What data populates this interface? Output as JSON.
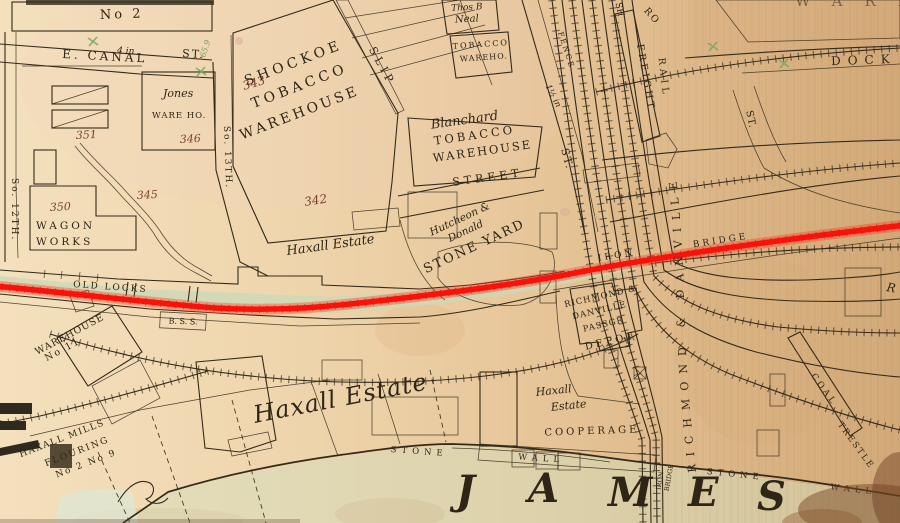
{
  "colors": {
    "annotation_red": "#fa120a",
    "paper": "#ecd0a7",
    "building_pink": "#efcfc0",
    "building_tan": "#e6c089",
    "green_lot": "#ccd8b8",
    "ink": "#332a1b",
    "parcel_number_red": "#7e4030",
    "survey_green": "#75a25f"
  },
  "labels": {
    "no2": "No 2",
    "e_canal": "E. CANAL",
    "pipe4": "4 in",
    "st_canal": "ST.",
    "s12": "So. 12TH.",
    "s13": "So. 13TH.",
    "m659": "65.9",
    "jones1": "Jones",
    "jones2": "WARE HO.",
    "n346": "346",
    "n351": "351",
    "n345": "345",
    "n350": "350",
    "wagon1": "WAGON",
    "wagon2": "WORKS",
    "n343": "343",
    "n342": "342",
    "shockoe1": "SHOCKOE",
    "shockoe2": "TOBACCO",
    "shockoe3": "WAREHOUSE",
    "slip": "SLIP",
    "neal1": "Thos B",
    "neal2": "Neal",
    "neal3": "TOBACCO",
    "neal4": "WAREHO.",
    "blanchard1": "Blanchard",
    "blanchard2": "TOBACCO",
    "blanchard3": "WAREHOUSE",
    "street": "STREET",
    "hutcheon1": "Hutcheon &",
    "hutcheon2": "Donald",
    "hutcheon3": "STONE YARD",
    "haxall_small": "Haxall Estate",
    "haxall_large": "Haxall Estate",
    "haxall3a": "Haxall",
    "haxall3b": "Estate",
    "pipe15": "1½ in",
    "st14": "ST.",
    "fence": "FENCE",
    "sh": "SH",
    "freight": "FREIGHT",
    "rail": "RAIL",
    "ro": "RO",
    "rd": "RICHMOND & DANVILLE",
    "st_cross": "ST.",
    "dock": "DOCK",
    "wareh_partial": "WAREH",
    "depot1": "RICHMOND &",
    "depot2": "DANVILLE",
    "depot3": "PASSGR",
    "depot4": "DEPOT",
    "old_locks": "OLD LOCKS",
    "bss": "B. S. S.",
    "iron_h": "IRON",
    "bridge_h": "BRIDGE",
    "iron_v": "IRON",
    "bridge_v": "BRIDGE",
    "wh11a": "WAREHOUSE",
    "wh11b": "No 11",
    "mills1": "HAXALL MILLS",
    "mills2": "FLOURING",
    "mills3": "No 2   No 9",
    "cooperage": "COOPERAGE",
    "stone1": "STONE",
    "wall1": "WALL",
    "stone2": "STONE",
    "wall2": "WALL",
    "river": [
      "J",
      "A",
      "M",
      "E",
      "S"
    ],
    "coal": "COAL",
    "trestle": "TRESTLE",
    "r_partial": "R"
  }
}
